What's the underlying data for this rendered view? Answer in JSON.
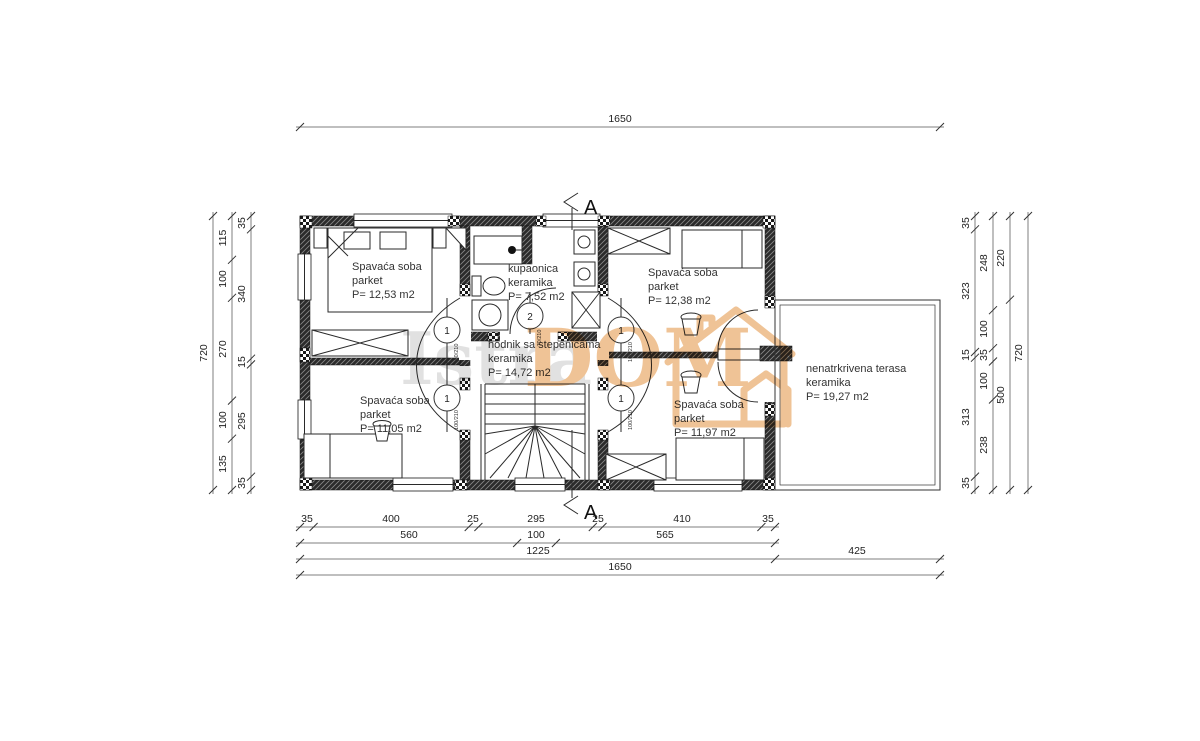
{
  "drawing": {
    "type": "floor-plan",
    "section_label": "A"
  },
  "watermark": {
    "text_gray": "Istra",
    "text_orange": "DOM",
    "color_gray": "#c9c9c9",
    "color_orange": "#e2913f"
  },
  "colors": {
    "wall": "#2b2b2b",
    "line": "#1a1a1a",
    "dimension": "#333333",
    "background": "#ffffff",
    "watermark_orange": "#e2913f"
  },
  "rooms": [
    {
      "id": "bedroom-top-left",
      "name": "Spavaća soba",
      "finish": "parket",
      "area": "P= 12,53 m2"
    },
    {
      "id": "bathroom",
      "name": "kupaonica",
      "finish": "keramika",
      "area": "P= 7,52 m2"
    },
    {
      "id": "bedroom-top-right",
      "name": "Spavaća soba",
      "finish": "parket",
      "area": "P= 12,38 m2"
    },
    {
      "id": "hallway",
      "name": "hodnik sa stepenicama",
      "finish": "keramika",
      "area": "P= 14,72 m2"
    },
    {
      "id": "bedroom-bottom-left",
      "name": "Spavaća soba",
      "finish": "parket",
      "area": "P= 11,05 m2"
    },
    {
      "id": "bedroom-bottom-right",
      "name": "Spavaća soba",
      "finish": "parket",
      "area": "P= 11,97 m2"
    },
    {
      "id": "terrace",
      "name": "nenatrkrivena terasa",
      "finish": "keramika",
      "area": "P= 19,27 m2"
    }
  ],
  "doors": [
    {
      "no": "1",
      "size": "80/210"
    },
    {
      "no": "1",
      "size": "100/210"
    },
    {
      "no": "2",
      "size": "70/210"
    },
    {
      "no": "1",
      "size": "100/210"
    },
    {
      "no": "1",
      "size": "100/210"
    }
  ],
  "dims": {
    "top": [
      "1650"
    ],
    "bottom": {
      "chain1": [
        "35",
        "400",
        "25",
        "295",
        "25",
        "410",
        "35"
      ],
      "chain2": [
        "560",
        "100",
        "565"
      ],
      "chain3": [
        "1225",
        "425"
      ],
      "chain4": [
        "1650"
      ]
    },
    "left": {
      "outer": [
        "720"
      ],
      "middle": [
        "115",
        "100",
        "270",
        "100",
        "135"
      ],
      "inner": [
        "35",
        "340",
        "15",
        "295",
        "35"
      ]
    },
    "right": {
      "inner": [
        "35",
        "323",
        "15",
        "313",
        "35"
      ],
      "second": [
        "248",
        "100",
        "35",
        "100",
        "238"
      ],
      "third": [
        "220",
        "500"
      ],
      "outer": [
        "720"
      ]
    }
  }
}
